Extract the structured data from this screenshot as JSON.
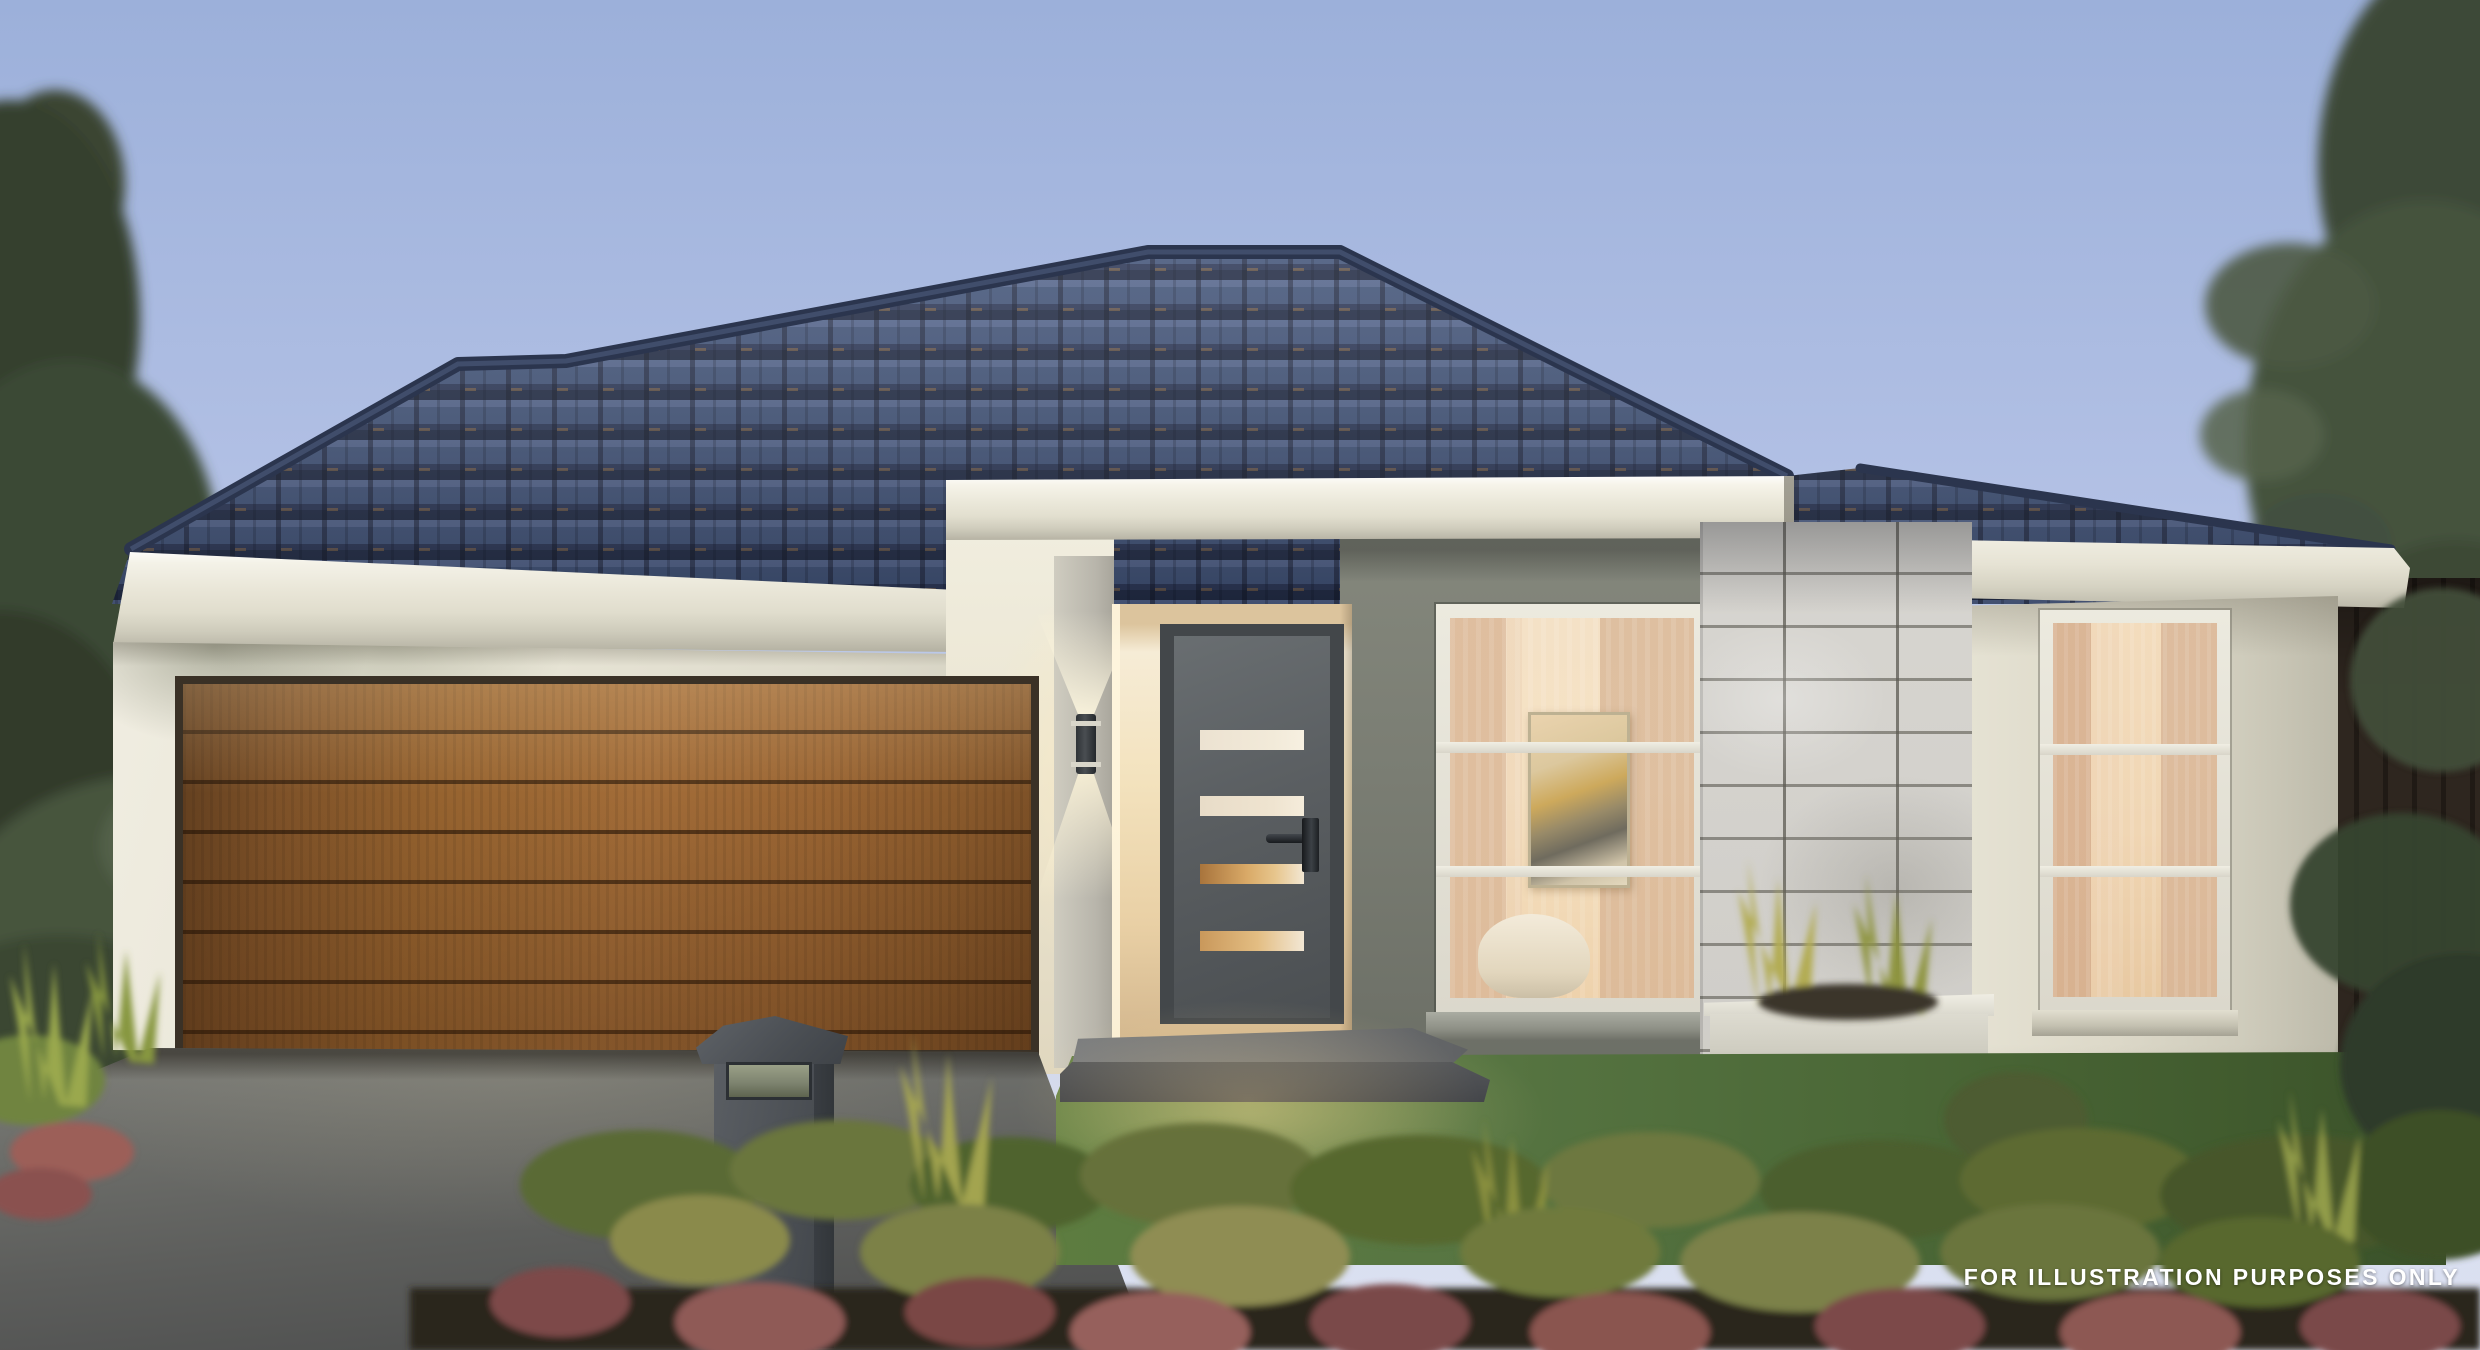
{
  "watermark": {
    "text": "FOR ILLUSTRATION PURPOSES ONLY"
  },
  "palette": {
    "sky_top": "#9cb0da",
    "sky_horizon": "#d6dcf0",
    "roof_tile": "#3f5176",
    "roof_shadow": "#1f2942",
    "ridge_cap": "#2b354e",
    "fascia_cream": "#eae7d9",
    "wall_cream": "#e8e5d6",
    "wall_grey": "#7a7d73",
    "door_grey": "#5a5e61",
    "door_glass_warm": "#d9a967",
    "garage_timber": "#96632f",
    "stone_tile": "#d5d3ce",
    "driveway_grey": "#5d5e5c",
    "lawn_green": "#4b6837",
    "garden_maroon": "#8a5450",
    "fence_brown": "#2e261f",
    "glow_warm": "#ffeec2",
    "watermark_text": "#ffffff"
  }
}
